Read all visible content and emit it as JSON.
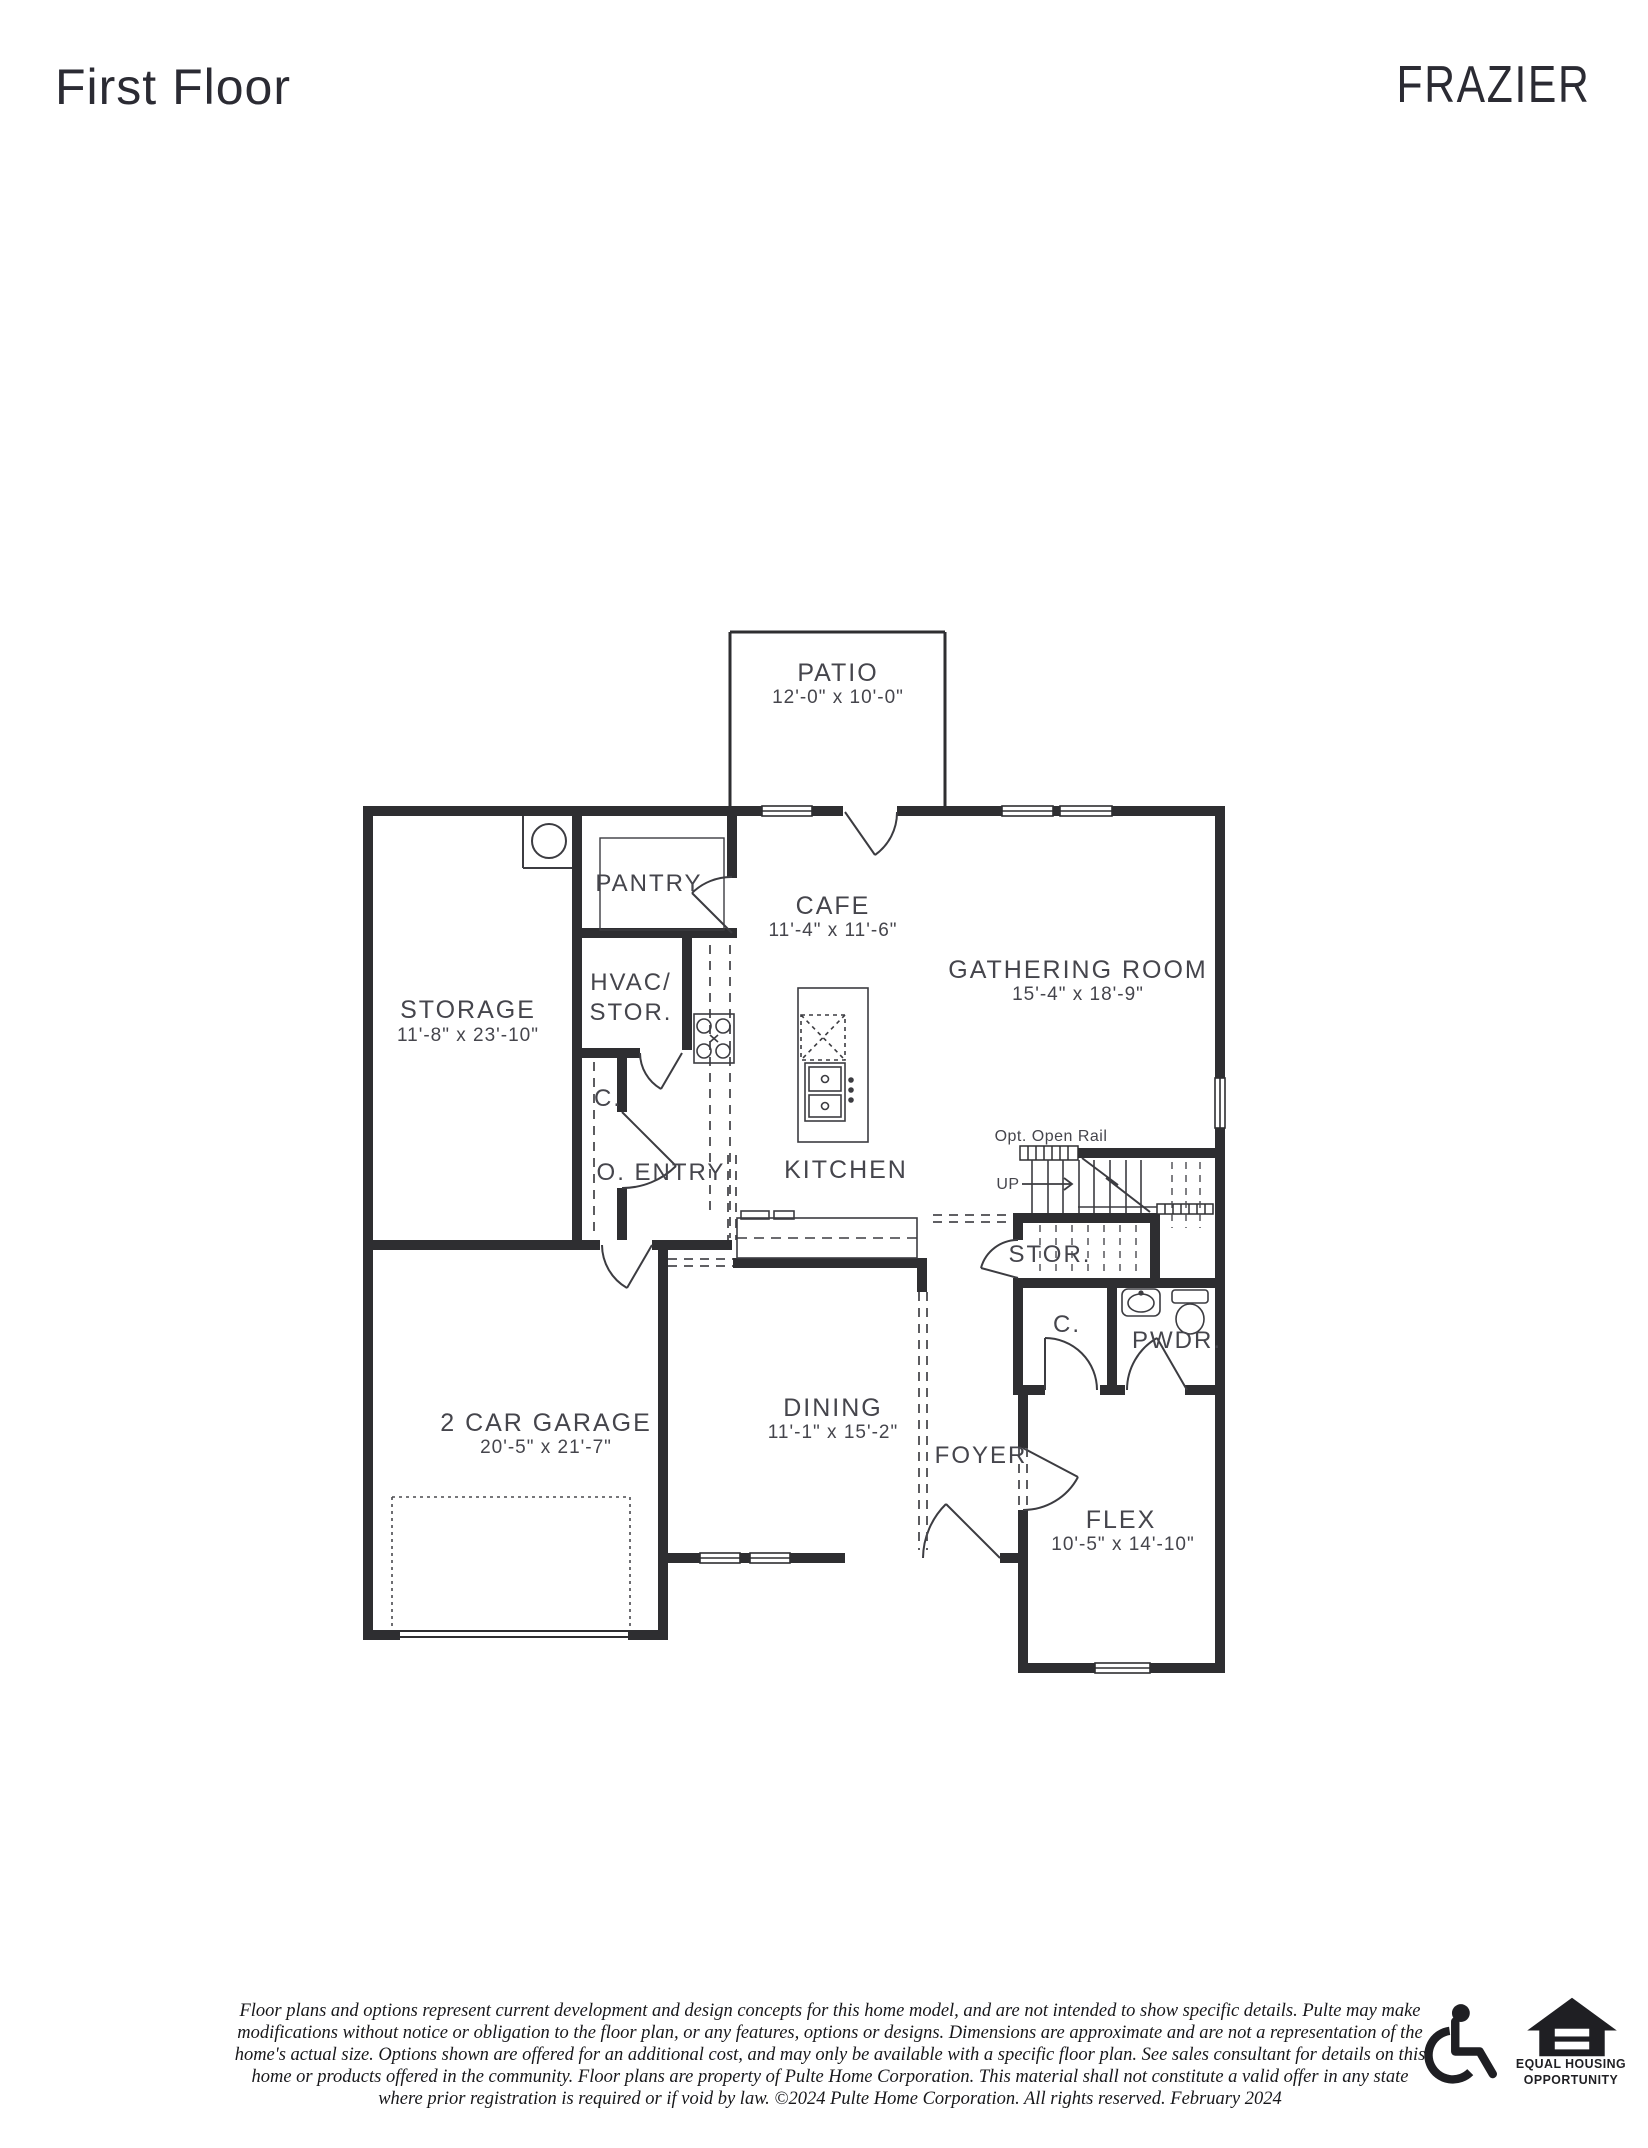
{
  "header": {
    "page_title": "First Floor",
    "plan_name": "FRAZIER"
  },
  "plan": {
    "patio": {
      "name": "PATIO",
      "dims": "12'-0\" x 10'-0\""
    },
    "cafe": {
      "name": "CAFE",
      "dims": "11'-4\" x 11'-6\""
    },
    "gathering_room": {
      "name": "GATHERING ROOM",
      "dims": "15'-4\" x 18'-9\""
    },
    "storage": {
      "name": "STORAGE",
      "dims": "11'-8\" x 23'-10\""
    },
    "pantry": {
      "name": "PANTRY"
    },
    "hvac_storage": {
      "line1": "HVAC/",
      "line2": "STOR."
    },
    "hall_closet": {
      "name": "C."
    },
    "owner_entry": {
      "name": "O. ENTRY"
    },
    "kitchen": {
      "name": "KITCHEN"
    },
    "stairs": {
      "rail_note": "Opt. Open Rail",
      "direction": "UP",
      "under_stair_storage": "STOR."
    },
    "foyer_closet": {
      "name": "C."
    },
    "powder_room": {
      "name": "PWDR."
    },
    "garage": {
      "name": "2 CAR GARAGE",
      "dims": "20'-5\" x 21'-7\""
    },
    "dining": {
      "name": "DINING",
      "dims": "11'-1\" x 15'-2\""
    },
    "foyer": {
      "name": "FOYER"
    },
    "flex": {
      "name": "FLEX",
      "dims": "10'-5\" x 14'-10\""
    }
  },
  "footer": {
    "disclaimer_lines": [
      "Floor plans and options represent current development and design concepts for this home model, and are not intended to show specific details.  Pulte may make",
      "modifications without notice or obligation to the floor plan, or any features, options or designs.  Dimensions are approximate and are not a representation of the",
      "home's actual size. Options shown are offered for an additional cost, and may only be available with a specific floor plan.  See sales consultant for details on this",
      "home or products offered in the community.  Floor plans are property of Pulte Home Corporation.  This material shall not constitute a valid offer in any state",
      "where prior registration is required or if void by law.   ©2024 Pulte Home Corporation.  All rights reserved.  February 2024"
    ],
    "equal_housing": {
      "line1": "EQUAL HOUSING",
      "line2": "OPPORTUNITY"
    }
  },
  "colors": {
    "wall": "#2e2e31",
    "label": "#45454c",
    "line": "#3c3c41"
  }
}
